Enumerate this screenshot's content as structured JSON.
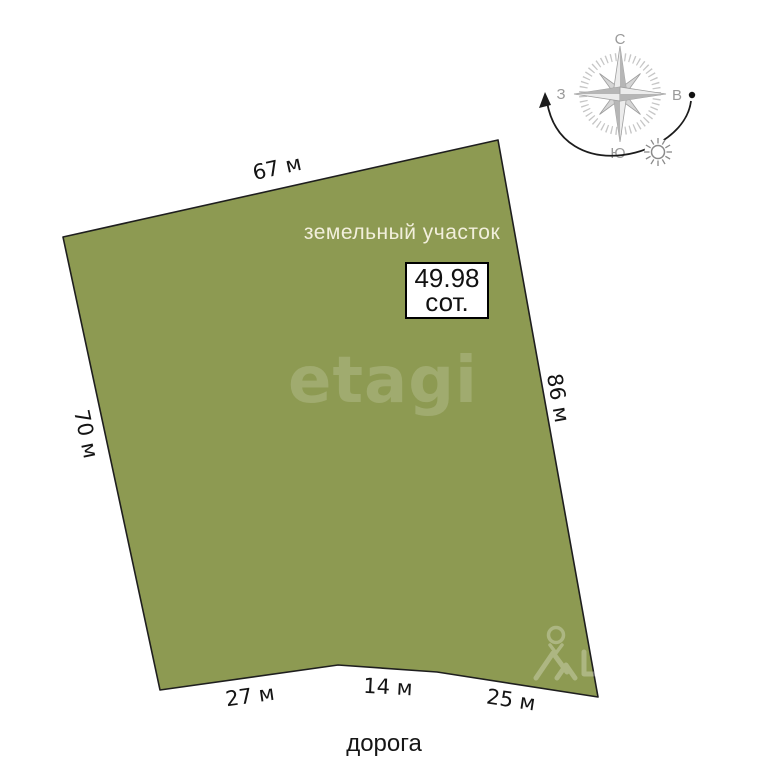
{
  "diagram": {
    "title": "земельный участок",
    "area": {
      "value": "49.98",
      "unit": "сот."
    },
    "sides": {
      "top": "67 м",
      "left": "70 м",
      "right": "86 м",
      "bottom_left": "27 м",
      "bottom_middle": "14 м",
      "bottom_right": "25 м"
    },
    "road": "дорога",
    "colors": {
      "plot_fill": "#8d9a52",
      "plot_outline": "#1e1e1e",
      "label_text": "#141414",
      "title_text": "#f2efdc",
      "compass_gray": "#9a9a9a",
      "sun_path": "#1c1c1c"
    }
  },
  "compass": {
    "north": "С",
    "south": "Ю",
    "west": "З",
    "east": "В"
  },
  "watermark": {
    "brand": "etagi"
  },
  "icons": {
    "compass_rose": "8-point-star",
    "sun": "radial-sun",
    "sun_path_arrow": "curved-arrow-west",
    "sun_path_dot": "dot-east",
    "map_pin": "location-pin",
    "house": "roof-outline"
  }
}
